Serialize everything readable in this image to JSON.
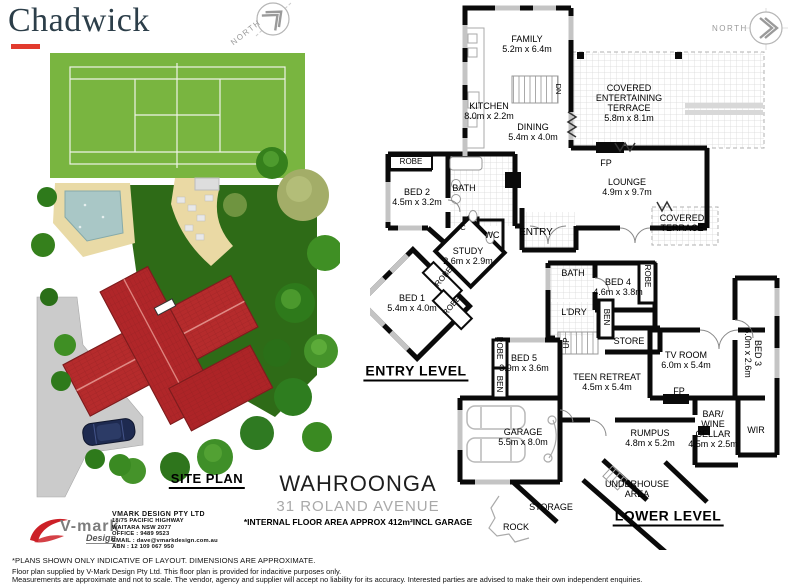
{
  "header": {
    "title": "Chadwick",
    "north_left": "NORTH",
    "north_right": "NORTH"
  },
  "site": {
    "title": "SITE PLAN"
  },
  "address": {
    "suburb": "WAHROONGA",
    "street": "31 ROLAND AVENUE",
    "note1": "*INTERNAL FLOOR AREA APPROX 412m²",
    "note2": "INCL GARAGE"
  },
  "entry": {
    "title": "ENTRY LEVEL",
    "family_name": "FAMILY",
    "family_dims": "5.2m x 6.4m",
    "kitchen_name": "KITCHEN",
    "kitchen_dims": "8.0m x 2.2m",
    "dining_name": "DINING",
    "dining_dims": "5.4m x 4.0m",
    "cet1": "COVERED",
    "cet2": "ENTERTAINING",
    "cet3": "TERRACE",
    "cet_dims": "5.8m x 8.1m",
    "lounge_name": "LOUNGE",
    "lounge_dims": "4.9m x 9.7m",
    "cterr1": "COVERED",
    "cterr2": "TERRACE",
    "bed2_name": "BED 2",
    "bed2_dims": "4.5m x 3.2m",
    "robe_bed2": "ROBE",
    "bath": "BATH",
    "fp": "FP",
    "dn": "DN",
    "study_name": "STUDY",
    "study_dims": "2.6m x 2.9m",
    "wc": "WC",
    "entry_label": "ENTRY",
    "closet_c": "C",
    "bed1_name": "BED 1",
    "bed1_dims": "5.4m x 4.0m",
    "robe_bed1a": "ROBE",
    "robe_bed1b": "ROBE"
  },
  "lower": {
    "title": "LOWER LEVEL",
    "bath": "BATH",
    "bed4_name": "BED 4",
    "bed4_dims": "4.6m x 3.8m",
    "robe_bed4": "ROBE",
    "ldry": "L'DRY",
    "ben_ldry": "BEN",
    "up": "UP",
    "store": "STORE",
    "tv_name": "TV ROOM",
    "tv_dims": "6.0m x 5.4m",
    "bed3_name": "BED 3",
    "bed3_dims": "6.0m x 2.6m",
    "bed5_name": "BED 5",
    "bed5_dims": "3.9m x 3.6m",
    "robe_bed5": "ROBE",
    "ben_bed5": "BEN",
    "teen_name": "TEEN RETREAT",
    "teen_dims": "4.5m x 5.4m",
    "fp": "FP",
    "garage_name": "GARAGE",
    "garage_dims": "5.5m x 8.0m",
    "rumpus_name": "RUMPUS",
    "rumpus_dims": "4.8m x 5.2m",
    "bar1": "BAR/",
    "bar2": "WINE",
    "bar3": "CELLAR",
    "bar_dims": "4.5m x 2.5m",
    "wir": "WIR",
    "under1": "UNDERHOUSE",
    "under2": "AREA",
    "storage": "STORAGE",
    "rock": "ROCK"
  },
  "footer": {
    "logo_main": "V-mark",
    "logo_sub": "Design",
    "company": "VMARK DESIGN PTY LTD",
    "addr1": "18/75 PACIFIC HIGHWAY",
    "addr2": "WAITARA NSW 2077",
    "addr3": "OFFICE : 9489 9523",
    "addr4": "EMAIL : dave@vmarkdesign.com.au",
    "addr5": "ABN : 12 109 067 950",
    "disc1": "*PLANS SHOWN ONLY INDICATIVE OF LAYOUT. DIMENSIONS ARE APPROXIMATE.",
    "disc2": "Floor plan supplied by V-Mark Design Pty Ltd. This floor plan is provided for indacitive purposes only.",
    "disc3": "Measurements are approximate and not to scale. The vendor, agency and supplier will accept no liability for its accuracy. Interested parties are advised to make their own independent enquiries."
  },
  "colors": {
    "accent_red": "#e23b2e",
    "roof_red": "#b52b2c",
    "court_green": "#79b540",
    "lawn_green": "#2e6b17",
    "pool_blue": "#a9c7c6",
    "sand": "#e9daa6",
    "wall_black": "#0a0a0a"
  }
}
